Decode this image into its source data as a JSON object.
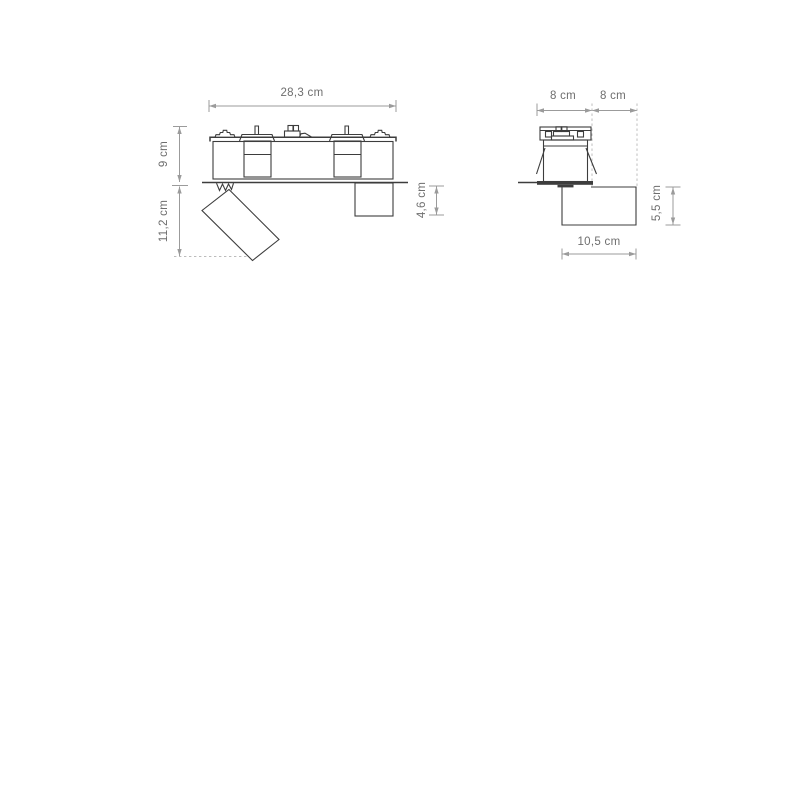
{
  "colors": {
    "bg": "#ffffff",
    "drawing": "#3d3d3d",
    "dim": "#9b9b9b",
    "dash": "#bcbcbc",
    "text": "#6e6e6e"
  },
  "front_view": {
    "width_label": "28,3 cm",
    "upper_height_label": "9 cm",
    "lower_height_label": "11,2 cm",
    "canopy_height_label": "4,6 cm"
  },
  "side_view": {
    "head_width_label": "8 cm",
    "offset_width_label": "8 cm",
    "canopy_height_label": "5,5 cm",
    "canopy_width_label": "10,5 cm"
  }
}
